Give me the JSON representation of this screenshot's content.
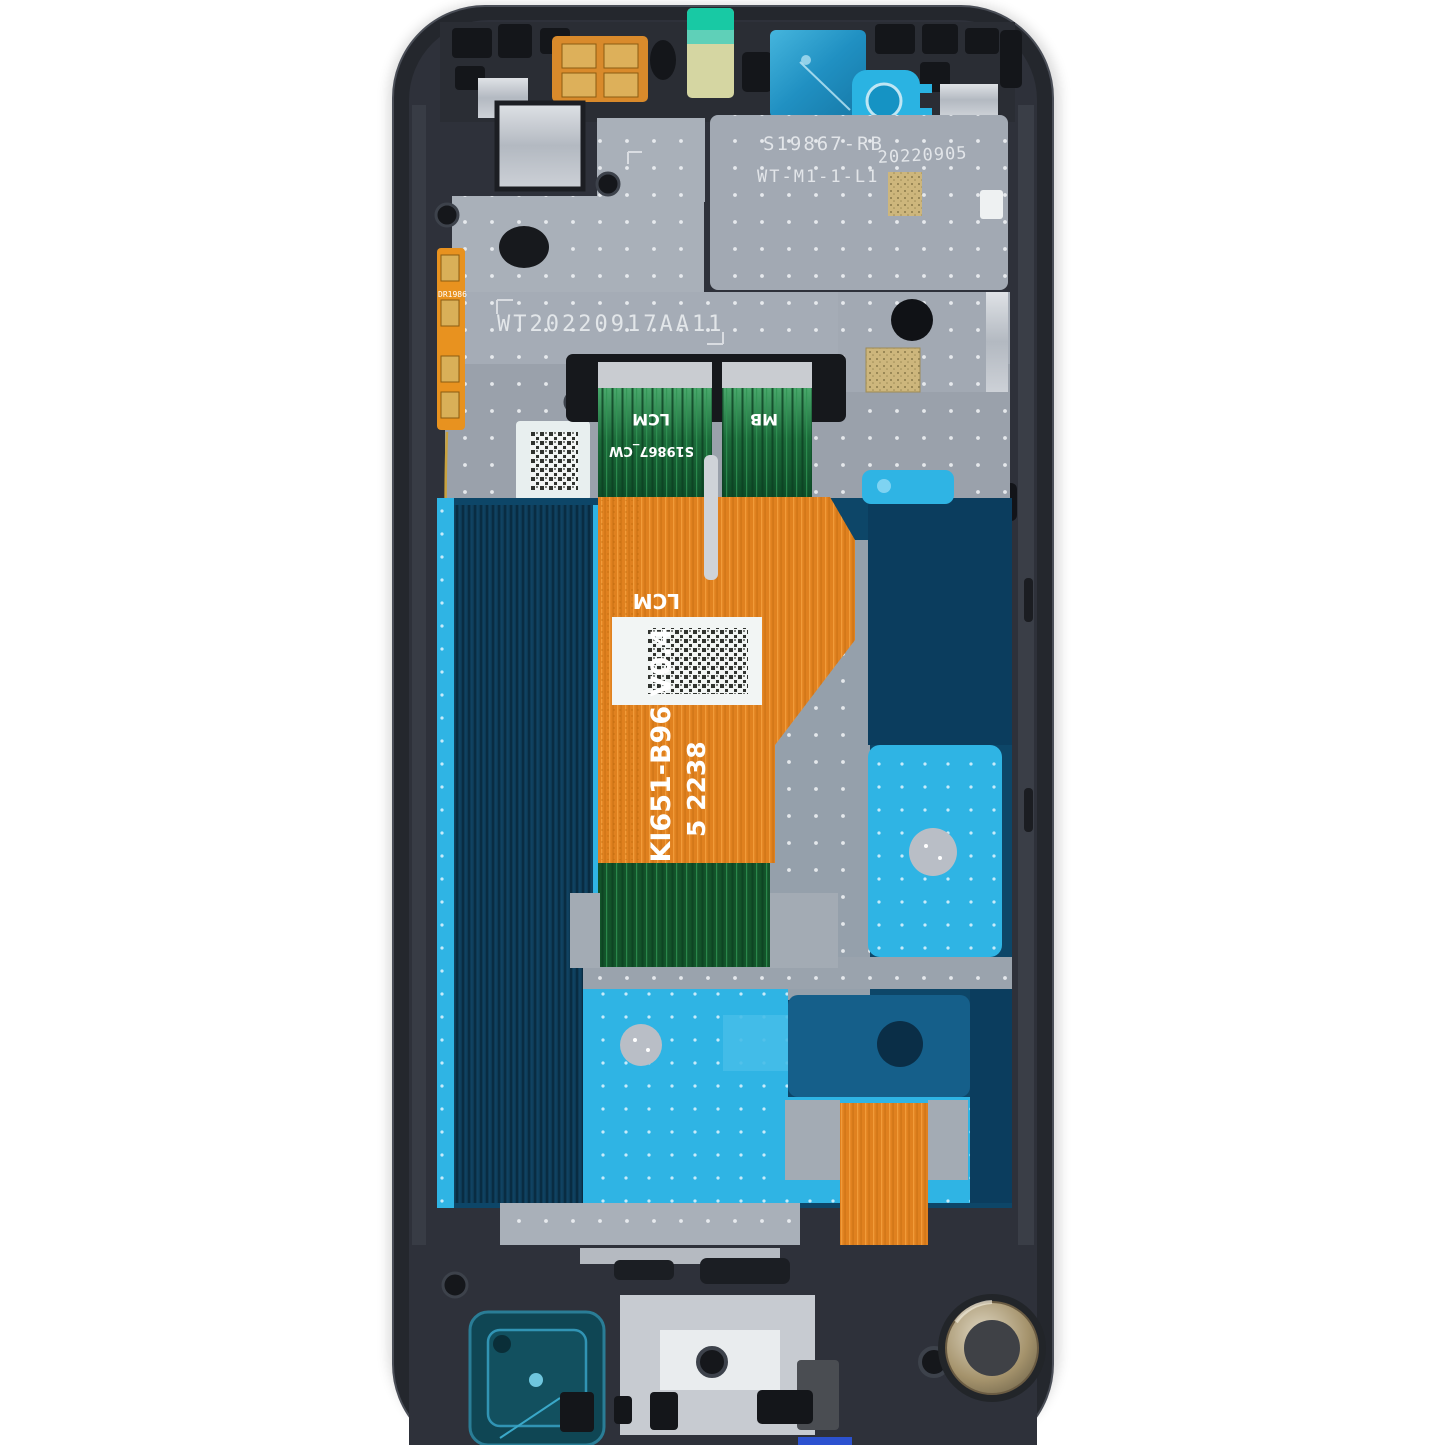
{
  "image": {
    "type": "product-photo",
    "subject": "smartphone display assembly with frame, internal rear view",
    "background_color": "#ffffff"
  },
  "markings": {
    "board_id": "S19867-RB",
    "model_code": "WT-M1-1-L1",
    "date_code": "20220905",
    "frame_serial": "WT20220917AA11",
    "lcm_connector_label": "LCM",
    "flex_code": "S19867_CW",
    "mb_connector_label": "MB",
    "main_flex_label": "LCM",
    "main_flex_part_number": "SKI651-B96  V0.4",
    "main_flex_lot": "5 2238",
    "side_flex_code": "DR1986"
  },
  "components": {
    "frame": "midframe-chassis",
    "shield": "perforated-metal-shield",
    "lcd_panel": "lcd-back-panel",
    "main_flex": "main-lcm-flex-cable",
    "bottom_flex": "bottom-flex-cable",
    "datamatrix_sticker": "datamatrix-sticker",
    "flex_label": "flex-datamatrix-label",
    "camera_film": "camera-window-film",
    "camera_ring": "camera-ring-sticker",
    "top_sticker": "teal-protective-sticker",
    "speaker": "loudspeaker-module",
    "motor": "vibration-motor",
    "adhesive": "cyan-adhesive-patches"
  },
  "colors": {
    "background": "#ffffff",
    "frame_dark": "#26292f",
    "shield_gray": "#a9b0b9",
    "lcd_navy": "#0d3a55",
    "deep_blue": "#0d4668",
    "adhesive_cyan": "#2fb4e4",
    "flex_orange": "#e0811f",
    "flex_green": "#176332",
    "gold_contact": "#d9b058",
    "sticker_teal": "#18c9a4",
    "film_blue": "#2090c2",
    "motor_bronze": "#9f8e6d",
    "bottom_tab_blue": "#2c52d0"
  }
}
